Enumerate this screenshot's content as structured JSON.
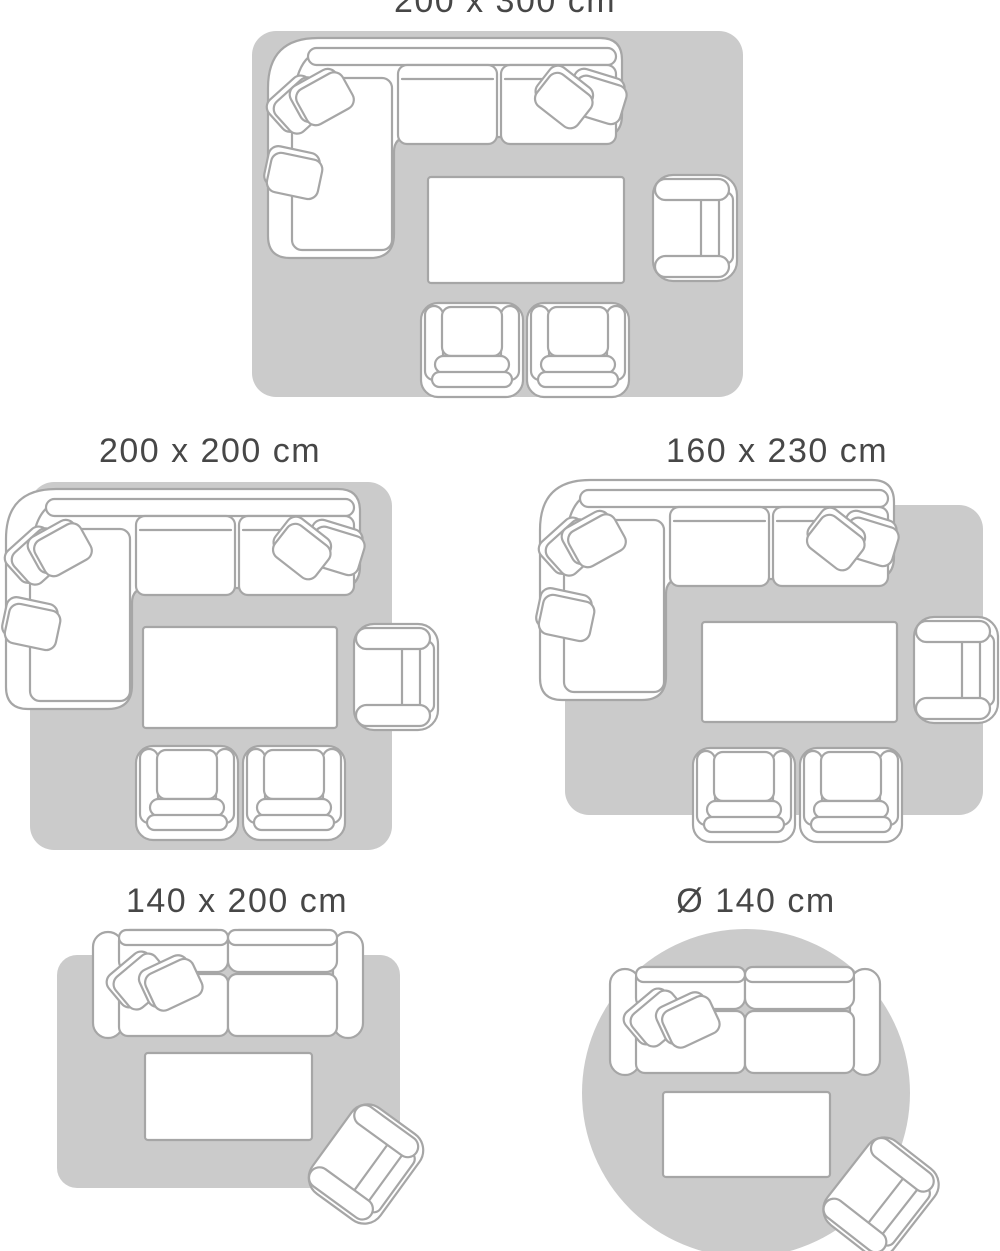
{
  "colors": {
    "page_bg": "#ffffff",
    "rug_fill": "#cbcbcb",
    "furniture_fill": "#ffffff",
    "furniture_outline": "#a6a6a6",
    "label_text": "#474747"
  },
  "size_guide": {
    "description": "Rug size guide with living-room furniture layouts",
    "layouts": [
      {
        "label": "200 x 300 cm",
        "shape": "rectangle"
      },
      {
        "label": "200 x 200 cm",
        "shape": "rectangle"
      },
      {
        "label": "160 x 230 cm",
        "shape": "rectangle"
      },
      {
        "label": "140 x 200 cm",
        "shape": "rectangle"
      },
      {
        "label": "Ø 140 cm",
        "shape": "round"
      }
    ]
  }
}
